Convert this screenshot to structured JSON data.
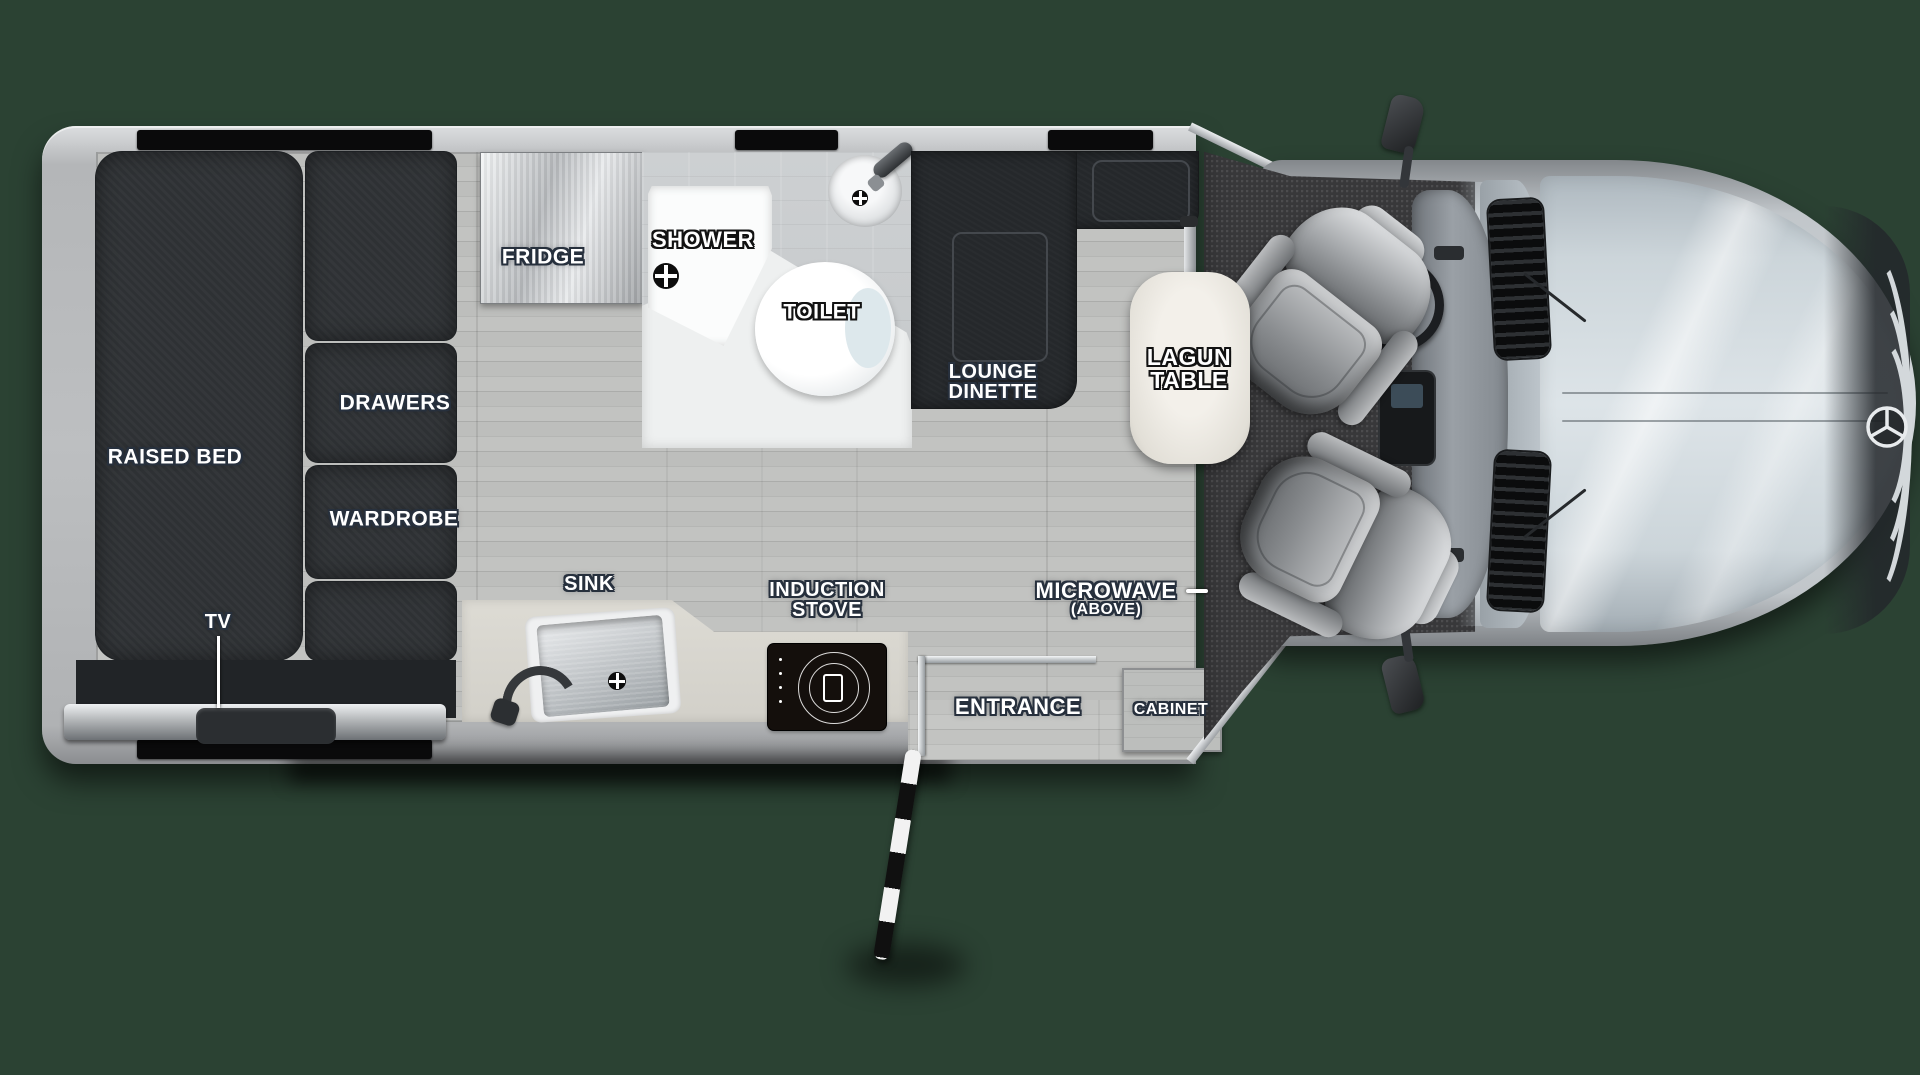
{
  "title": "RV floor plan - top view",
  "colors": {
    "background": "#2b4233",
    "coach_wall": "#b9bbbd",
    "floor_wood": "#b7b8b6",
    "furniture_dark": "#2e3134",
    "counter": "#dbd9d2",
    "carpet": "#38383a",
    "hood": "#ccd5da",
    "label_text": "#ffffff",
    "label_outline": "#27303d",
    "window_bar": "#0a0a0b"
  },
  "labels": {
    "raised_bed": "RAISED BED",
    "drawers": "DRAWERS",
    "wardrobe": "WARDROBE",
    "tv": "TV",
    "fridge": "FRIDGE",
    "shower": "SHOWER",
    "toilet": "TOILET",
    "lounge_dinette": {
      "line1": "LOUNGE",
      "line2": "DINETTE"
    },
    "lagun_table": {
      "line1": "LAGUN",
      "line2": "TABLE"
    },
    "sink": "SINK",
    "induction_stove": {
      "line1": "INDUCTION",
      "line2": "STOVE"
    },
    "microwave": {
      "line1": "MICROWAVE",
      "line2": "(ABOVE)"
    },
    "entrance": "ENTRANCE",
    "cabinet": "CABINET"
  }
}
